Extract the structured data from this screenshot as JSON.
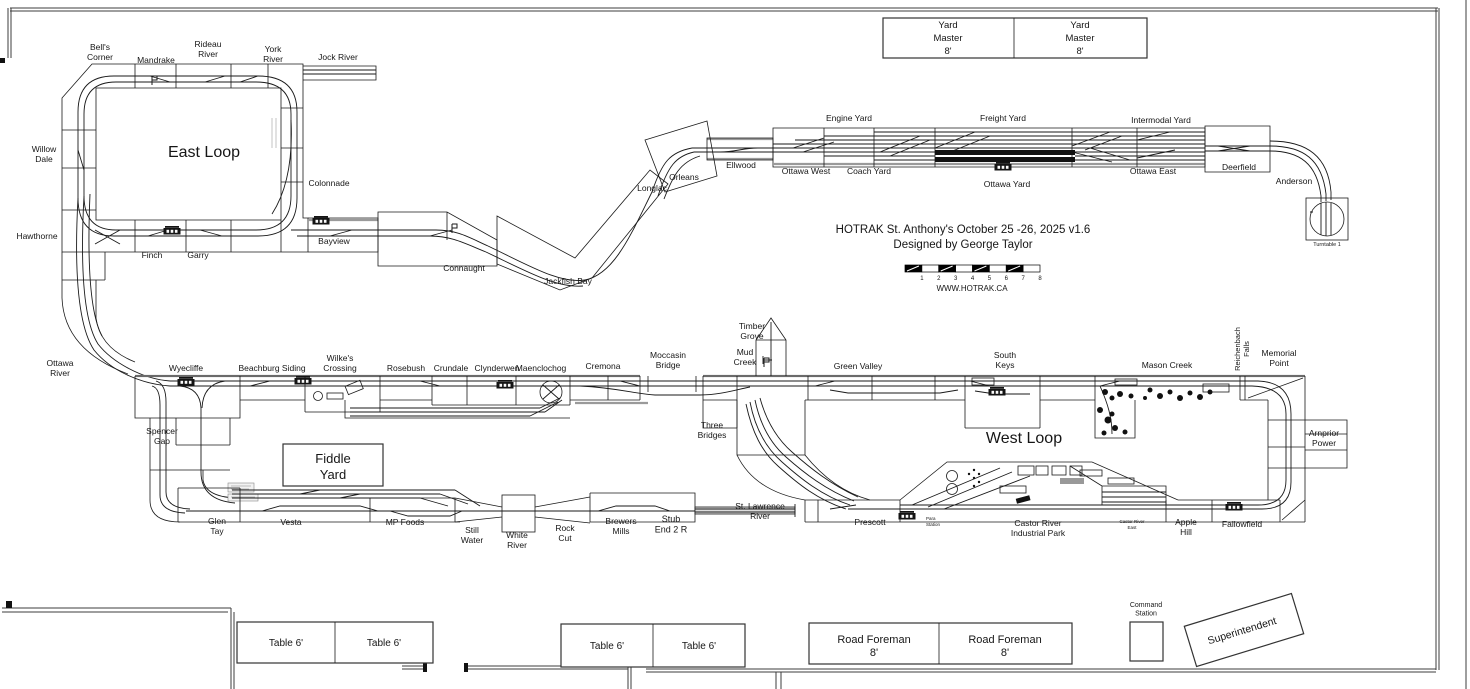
{
  "plan": {
    "title": "HOTRAK St. Anthony's October 25 -26, 2025 v1.6",
    "designer": "Designed by George Taylor",
    "website": "WWW.HOTRAK.CA"
  },
  "scale_bar": {
    "numbers": [
      "1",
      "2",
      "3",
      "4",
      "5",
      "6",
      "7",
      "8"
    ]
  },
  "colors": {
    "ink": "#161616",
    "bench_gray": "#9a9a9a",
    "paper": "#ffffff"
  },
  "labels": [
    {
      "t": "Bell's\nCorner",
      "x": 100,
      "y": 50
    },
    {
      "t": "Mandrake",
      "x": 156,
      "y": 63
    },
    {
      "t": "Rideau\nRiver",
      "x": 208,
      "y": 47
    },
    {
      "t": "York\nRiver",
      "x": 273,
      "y": 52
    },
    {
      "t": "Jock River",
      "x": 338,
      "y": 60
    },
    {
      "t": "East Loop",
      "x": 204,
      "y": 157,
      "s": 16,
      "n": "east-loop-label"
    },
    {
      "t": "Willow\nDale",
      "x": 44,
      "y": 152
    },
    {
      "t": "Hawthorne",
      "x": 37,
      "y": 239
    },
    {
      "t": "Colonnade",
      "x": 329,
      "y": 186
    },
    {
      "t": "Finch",
      "x": 152,
      "y": 258
    },
    {
      "t": "Garry",
      "x": 198,
      "y": 258
    },
    {
      "t": "Bayview",
      "x": 334,
      "y": 244
    },
    {
      "t": "Connaught",
      "x": 464,
      "y": 271
    },
    {
      "t": "Jackfish Bay",
      "x": 568,
      "y": 284
    },
    {
      "t": "Longlac",
      "x": 652,
      "y": 191
    },
    {
      "t": "Orleans",
      "x": 684,
      "y": 180
    },
    {
      "t": "Ellwood",
      "x": 741,
      "y": 168
    },
    {
      "t": "Ottawa West",
      "x": 806,
      "y": 174
    },
    {
      "t": "Coach Yard",
      "x": 869,
      "y": 174
    },
    {
      "t": "Engine Yard",
      "x": 849,
      "y": 121
    },
    {
      "t": "Freight Yard",
      "x": 1003,
      "y": 121
    },
    {
      "t": "Ottawa Yard",
      "x": 1007,
      "y": 187
    },
    {
      "t": "Intermodal Yard",
      "x": 1161,
      "y": 123
    },
    {
      "t": "Ottawa East",
      "x": 1153,
      "y": 174
    },
    {
      "t": "Deerfield",
      "x": 1239,
      "y": 170
    },
    {
      "t": "Anderson",
      "x": 1294,
      "y": 184
    },
    {
      "t": "Turntable 1",
      "x": 1327,
      "y": 246,
      "s": 5.5
    },
    {
      "t": "Yard\nMaster\n8'",
      "x": 948,
      "y": 28,
      "s": 9.5,
      "lh": 13,
      "n": "yard-master-label"
    },
    {
      "t": "Yard\nMaster\n8'",
      "x": 1080,
      "y": 28,
      "s": 9.5,
      "lh": 13,
      "n": "yard-master-label"
    },
    {
      "t": "HOTRAK St. Anthony's October 25 -26, 2025 v1.6",
      "x": 963,
      "y": 233,
      "s": 11.5,
      "n": "plan-title"
    },
    {
      "t": "Designed by George Taylor",
      "x": 963,
      "y": 248,
      "s": 11.5,
      "n": "plan-designer"
    },
    {
      "t": "WWW.HOTRAK.CA",
      "x": 972,
      "y": 291,
      "s": 8,
      "n": "plan-website"
    },
    {
      "t": "Ottawa\nRiver",
      "x": 60,
      "y": 366
    },
    {
      "t": "Wyecliffe",
      "x": 186,
      "y": 371
    },
    {
      "t": "Beachburg Siding",
      "x": 272,
      "y": 371
    },
    {
      "t": "Wilke's\nCrossing",
      "x": 340,
      "y": 361
    },
    {
      "t": "Rosebush",
      "x": 406,
      "y": 371
    },
    {
      "t": "Crundale",
      "x": 451,
      "y": 371
    },
    {
      "t": "Clynderwen",
      "x": 497,
      "y": 371
    },
    {
      "t": "Maenclochog",
      "x": 541,
      "y": 371
    },
    {
      "t": "Cremona",
      "x": 603,
      "y": 369
    },
    {
      "t": "Moccasin\nBridge",
      "x": 668,
      "y": 358
    },
    {
      "t": "Mud\nCreek",
      "x": 745,
      "y": 355
    },
    {
      "t": "Timber\nGrove",
      "x": 752,
      "y": 329
    },
    {
      "t": "Green Valley",
      "x": 858,
      "y": 369
    },
    {
      "t": "South\nKeys",
      "x": 1005,
      "y": 358
    },
    {
      "t": "Mason Creek",
      "x": 1167,
      "y": 368
    },
    {
      "t": "Reichenbach\nFalls",
      "x": 1240,
      "y": 349,
      "s": 7.5,
      "r": -90
    },
    {
      "t": "Memorial\nPoint",
      "x": 1279,
      "y": 356
    },
    {
      "t": "Spencer\nGap",
      "x": 162,
      "y": 434
    },
    {
      "t": "Fiddle\nYard",
      "x": 333,
      "y": 463,
      "s": 13,
      "lh": 16,
      "n": "fiddle-yard-label"
    },
    {
      "t": "Three\nBridges",
      "x": 712,
      "y": 428
    },
    {
      "t": "West Loop",
      "x": 1024,
      "y": 443,
      "s": 16,
      "n": "west-loop-label"
    },
    {
      "t": "Arnprior\nPower",
      "x": 1324,
      "y": 436
    },
    {
      "t": "Glen\nTay",
      "x": 217,
      "y": 524
    },
    {
      "t": "Vesta",
      "x": 291,
      "y": 525
    },
    {
      "t": "MP Foods",
      "x": 405,
      "y": 525
    },
    {
      "t": "Still\nWater",
      "x": 472,
      "y": 533
    },
    {
      "t": "White\nRiver",
      "x": 517,
      "y": 538
    },
    {
      "t": "Rock\nCut",
      "x": 565,
      "y": 531
    },
    {
      "t": "Brewers\nMills",
      "x": 621,
      "y": 524
    },
    {
      "t": "Stub\nEnd 2 R",
      "x": 671,
      "y": 522,
      "s": 9
    },
    {
      "t": "St. Lawrence\nRiver",
      "x": 760,
      "y": 509
    },
    {
      "t": "Prescott",
      "x": 870,
      "y": 525
    },
    {
      "t": "Para\nStation",
      "x": 926,
      "y": 520,
      "s": 4.5,
      "a": "start"
    },
    {
      "t": "Castor River\nIndustrial Park",
      "x": 1038,
      "y": 526
    },
    {
      "t": "Castor River\nEast",
      "x": 1132,
      "y": 523,
      "s": 4.5
    },
    {
      "t": "Apple\nHill",
      "x": 1186,
      "y": 525
    },
    {
      "t": "Fallowfield",
      "x": 1242,
      "y": 527
    },
    {
      "t": "Table 6'",
      "x": 286,
      "y": 646,
      "s": 10,
      "n": "table-label"
    },
    {
      "t": "Table 6'",
      "x": 384,
      "y": 646,
      "s": 10,
      "n": "table-label"
    },
    {
      "t": "Table 6'",
      "x": 607,
      "y": 649,
      "s": 10,
      "n": "table-label"
    },
    {
      "t": "Table 6'",
      "x": 699,
      "y": 649,
      "s": 10,
      "n": "table-label"
    },
    {
      "t": "Road Foreman\n8'",
      "x": 874,
      "y": 643,
      "s": 11,
      "lh": 13,
      "n": "road-foreman-label"
    },
    {
      "t": "Road Foreman\n8'",
      "x": 1005,
      "y": 643,
      "s": 11,
      "lh": 13,
      "n": "road-foreman-label"
    },
    {
      "t": "Command\nStation",
      "x": 1146,
      "y": 607,
      "s": 7,
      "n": "command-station-label"
    },
    {
      "t": "Superintendent",
      "x": 1243,
      "y": 634,
      "s": 10.5,
      "r": -17,
      "n": "superintendent-label"
    }
  ],
  "icons": [
    {
      "n": "station-building-icon",
      "x": 172,
      "y": 231
    },
    {
      "n": "station-building-icon",
      "x": 321,
      "y": 221
    },
    {
      "n": "station-building-icon",
      "x": 303,
      "y": 381
    },
    {
      "n": "station-building-icon",
      "x": 186,
      "y": 382
    },
    {
      "n": "station-building-icon",
      "x": 505,
      "y": 385
    },
    {
      "n": "station-building-icon",
      "x": 997,
      "y": 392
    },
    {
      "n": "station-building-icon",
      "x": 1003,
      "y": 167
    },
    {
      "n": "station-building-icon",
      "x": 907,
      "y": 516
    },
    {
      "n": "station-building-icon",
      "x": 1234,
      "y": 507
    },
    {
      "n": "flag-icon",
      "x": 152,
      "y": 76
    },
    {
      "n": "flag-icon",
      "x": 452,
      "y": 224
    },
    {
      "n": "flag-icon",
      "x": 764,
      "y": 358
    }
  ]
}
